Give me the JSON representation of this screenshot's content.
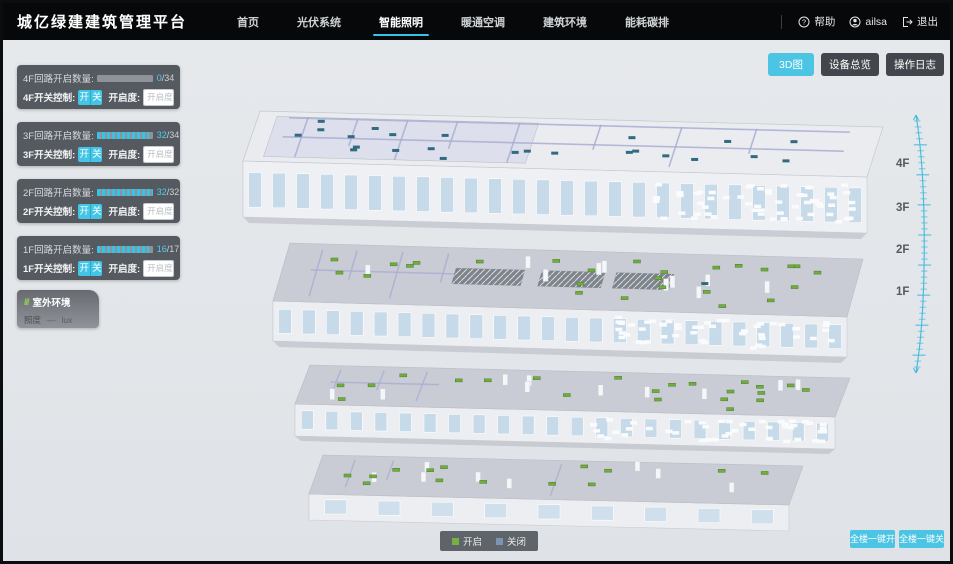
{
  "header": {
    "title": "城亿绿建建筑管理平台",
    "nav": [
      {
        "label": "首页",
        "active": false
      },
      {
        "label": "光伏系统",
        "active": false
      },
      {
        "label": "智能照明",
        "active": true
      },
      {
        "label": "暖通空调",
        "active": false
      },
      {
        "label": "建筑环境",
        "active": false
      },
      {
        "label": "能耗碳排",
        "active": false
      }
    ],
    "help": "帮助",
    "user": "ailsa",
    "logout": "退出"
  },
  "toolbar": {
    "view_3d": "3D图",
    "device_overview": "设备总览",
    "operation_log": "操作日志"
  },
  "strings": {
    "slash": "/",
    "percent": "%"
  },
  "floors": [
    {
      "name": "4F",
      "circuit_label": "4F回路开启数量:",
      "on": 0,
      "total": 34,
      "switch_label": "4F开关控制:",
      "btn_on": "开",
      "btn_off": "关",
      "dim_label": "开启度:",
      "dim_placeholder": "开启度"
    },
    {
      "name": "3F",
      "circuit_label": "3F回路开启数量:",
      "on": 32,
      "total": 34,
      "switch_label": "3F开关控制:",
      "btn_on": "开",
      "btn_off": "关",
      "dim_label": "开启度:",
      "dim_placeholder": "开启度"
    },
    {
      "name": "2F",
      "circuit_label": "2F回路开启数量:",
      "on": 32,
      "total": 32,
      "switch_label": "2F开关控制:",
      "btn_on": "开",
      "btn_off": "关",
      "dim_label": "开启度:",
      "dim_placeholder": "开启度"
    },
    {
      "name": "1F",
      "circuit_label": "1F回路开启数量:",
      "on": 16,
      "total": 17,
      "switch_label": "1F开关控制:",
      "btn_on": "开",
      "btn_off": "关",
      "dim_label": "开启度:",
      "dim_placeholder": "开启度"
    }
  ],
  "outdoor": {
    "icon": "///",
    "title": "室外环境",
    "metric": "照度",
    "value": "—",
    "unit": "lux"
  },
  "floor_axis": [
    "4F",
    "3F",
    "2F",
    "1F"
  ],
  "legend": {
    "on_label": "开启",
    "off_label": "关闭",
    "on_color": "#76b043",
    "off_color": "#7d95b5"
  },
  "bulk": {
    "all_on": "全楼一键开",
    "all_off": "全楼一键关"
  },
  "colors": {
    "accent": "#35c3e8",
    "button_cyan": "#4cc5e4",
    "panel_dark": "#4d5259",
    "marker_on": "#6fae3e",
    "marker_off": "#336a80"
  }
}
